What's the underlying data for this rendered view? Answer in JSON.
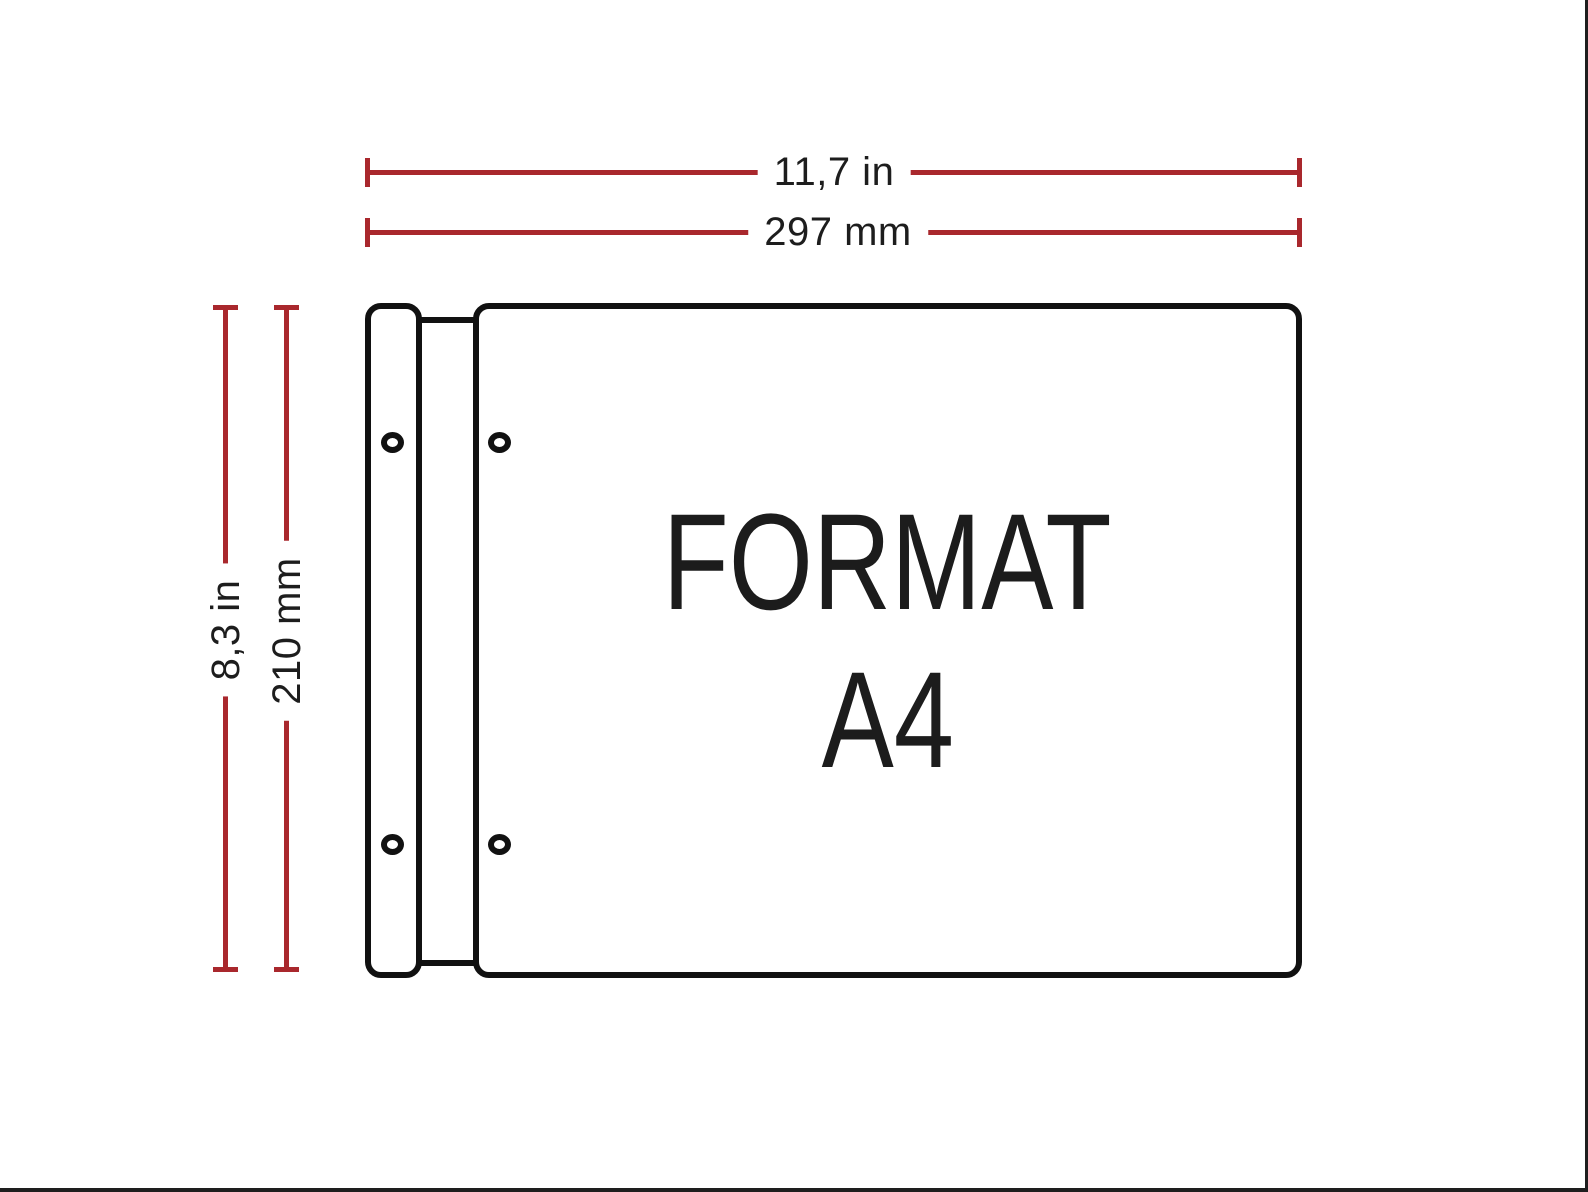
{
  "diagram": {
    "paper_format": "A4",
    "orientation": "landscape",
    "title_line1": "FORMAT",
    "title_line2": "A4",
    "dimensions": {
      "width_in": "11,7 in",
      "width_mm": "297 mm",
      "height_in": "8,3 in",
      "height_mm": "210 mm"
    },
    "holes_count": 4,
    "colors": {
      "dimension_line": "#a9282d",
      "outline": "#111111",
      "text": "#1d1d1d",
      "background": "#ffffff"
    }
  }
}
